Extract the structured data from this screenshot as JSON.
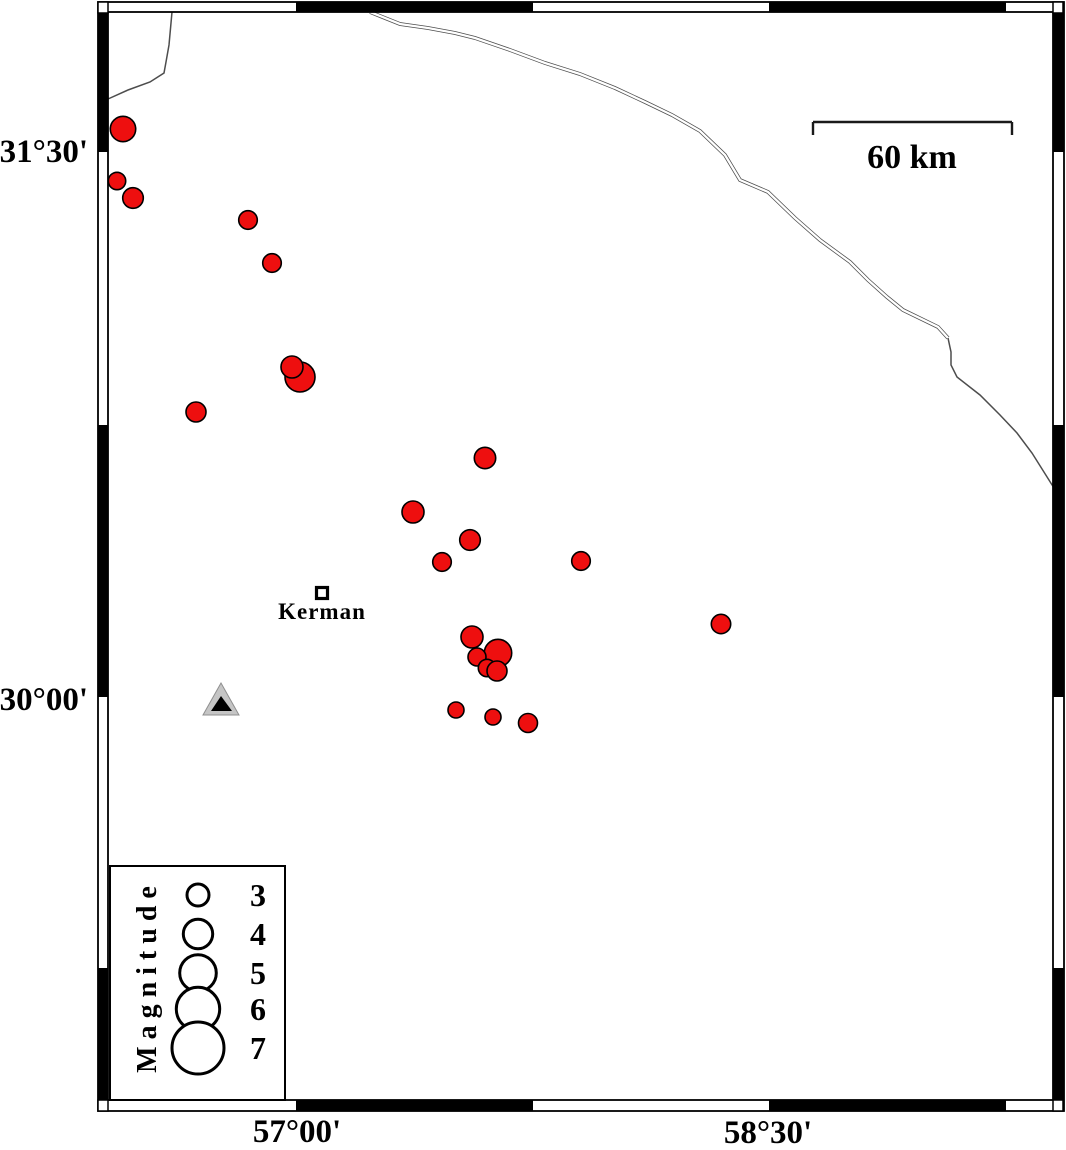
{
  "figure": {
    "type": "seismicity-map",
    "width": 1066,
    "height": 1150,
    "background": "#ffffff"
  },
  "colors": {
    "epicenter_fill": "#ee0f0f",
    "epicenter_stroke": "#000000",
    "frame_black": "#000000",
    "frame_white": "#ffffff",
    "border_line": "#4d4d4d",
    "station_fill": "#c5c5c5",
    "station_edge": "#8f8f8f",
    "station_inner": "#000000",
    "legend_circle_stroke": "#000000"
  },
  "axis": {
    "lat_labels": [
      {
        "text": "31°30'",
        "x_right": 88,
        "y_center": 152
      },
      {
        "text": "30°00'",
        "x_right": 88,
        "y_center": 700
      }
    ],
    "lon_labels": [
      {
        "text": "57°00'",
        "x_center": 297,
        "y_center": 1132
      },
      {
        "text": "58°30'",
        "x_center": 768,
        "y_center": 1133
      }
    ]
  },
  "frame": {
    "outer": {
      "x": 98,
      "y": 2,
      "w": 966,
      "h": 1109
    },
    "inner": {
      "x": 108,
      "y": 12,
      "w": 945,
      "h": 1088
    },
    "band": 10,
    "top_black": [
      [
        296,
        533
      ],
      [
        769,
        1006
      ]
    ],
    "bottom_black": [
      [
        296,
        533
      ],
      [
        769,
        1006
      ]
    ],
    "left_black": [
      [
        12,
        152
      ],
      [
        425,
        697
      ],
      [
        968,
        1100
      ]
    ],
    "right_black": [
      [
        12,
        152
      ],
      [
        425,
        697
      ],
      [
        968,
        1100
      ]
    ]
  },
  "scalebar": {
    "label": "60 km",
    "x1": 813,
    "x2": 1012,
    "y": 122,
    "tick_drop": 13,
    "label_x": 912,
    "label_y": 158
  },
  "city": {
    "name": "Kerman",
    "marker": {
      "x": 322,
      "y": 593,
      "size": 11
    },
    "label_x": 322,
    "label_y": 612
  },
  "station": {
    "outer_points": [
      [
        221,
        683
      ],
      [
        203,
        715
      ],
      [
        239,
        715
      ]
    ],
    "inner_points": [
      [
        221,
        696
      ],
      [
        211,
        711
      ],
      [
        232,
        711
      ]
    ]
  },
  "epicenters": [
    {
      "x": 123,
      "y": 129,
      "r": 12.7
    },
    {
      "x": 117,
      "y": 181,
      "r": 8.7
    },
    {
      "x": 133,
      "y": 198,
      "r": 10.3
    },
    {
      "x": 248,
      "y": 220,
      "r": 9.3
    },
    {
      "x": 272,
      "y": 263,
      "r": 9.3
    },
    {
      "x": 300,
      "y": 377,
      "r": 15
    },
    {
      "x": 292,
      "y": 367,
      "r": 11
    },
    {
      "x": 196,
      "y": 412,
      "r": 10
    },
    {
      "x": 485,
      "y": 458,
      "r": 10.7
    },
    {
      "x": 413,
      "y": 512,
      "r": 11
    },
    {
      "x": 470,
      "y": 540,
      "r": 10.3
    },
    {
      "x": 442,
      "y": 562,
      "r": 9.3
    },
    {
      "x": 581,
      "y": 561,
      "r": 9.3
    },
    {
      "x": 721,
      "y": 624,
      "r": 9.7
    },
    {
      "x": 498,
      "y": 653,
      "r": 13.7
    },
    {
      "x": 472,
      "y": 637,
      "r": 11
    },
    {
      "x": 477,
      "y": 657,
      "r": 9
    },
    {
      "x": 487,
      "y": 668,
      "r": 8.7
    },
    {
      "x": 497,
      "y": 671,
      "r": 10
    },
    {
      "x": 456,
      "y": 710,
      "r": 8
    },
    {
      "x": 493,
      "y": 717,
      "r": 8
    },
    {
      "x": 528,
      "y": 723,
      "r": 9.5
    }
  ],
  "borders": [
    {
      "style": "single",
      "points": [
        [
          172,
          12
        ],
        [
          169,
          45
        ],
        [
          166,
          62
        ],
        [
          164,
          73
        ],
        [
          150,
          82
        ],
        [
          128,
          90
        ],
        [
          108,
          99
        ]
      ]
    },
    {
      "style": "double",
      "points": [
        [
          370,
          12
        ],
        [
          400,
          24
        ],
        [
          428,
          28
        ],
        [
          455,
          33
        ],
        [
          475,
          38
        ],
        [
          510,
          50
        ],
        [
          545,
          63
        ],
        [
          580,
          74
        ],
        [
          615,
          88
        ],
        [
          645,
          102
        ],
        [
          672,
          115
        ],
        [
          700,
          131
        ],
        [
          725,
          155
        ],
        [
          740,
          180
        ],
        [
          768,
          192
        ],
        [
          795,
          218
        ],
        [
          820,
          240
        ],
        [
          850,
          262
        ],
        [
          868,
          280
        ],
        [
          887,
          297
        ],
        [
          903,
          310
        ],
        [
          938,
          327
        ],
        [
          948,
          338
        ]
      ]
    },
    {
      "style": "single",
      "points": [
        [
          948,
          338
        ],
        [
          951,
          352
        ],
        [
          951,
          365
        ],
        [
          957,
          377
        ],
        [
          980,
          395
        ],
        [
          1000,
          415
        ],
        [
          1017,
          433
        ],
        [
          1032,
          453
        ],
        [
          1054,
          488
        ]
      ]
    }
  ],
  "legend": {
    "title": "Magnitude",
    "box": {
      "x": 110,
      "y": 866,
      "w": 175,
      "h": 234
    },
    "title_x": 148,
    "title_y": 976,
    "circle_x": 198,
    "value_x": 258,
    "entries": [
      {
        "magnitude": "3",
        "y": 895,
        "radius": 11
      },
      {
        "magnitude": "4",
        "y": 934,
        "radius": 14.7
      },
      {
        "magnitude": "5",
        "y": 973,
        "radius": 18.3
      },
      {
        "magnitude": "6",
        "y": 1009,
        "radius": 21.7
      },
      {
        "magnitude": "7",
        "y": 1048,
        "radius": 26
      }
    ]
  }
}
